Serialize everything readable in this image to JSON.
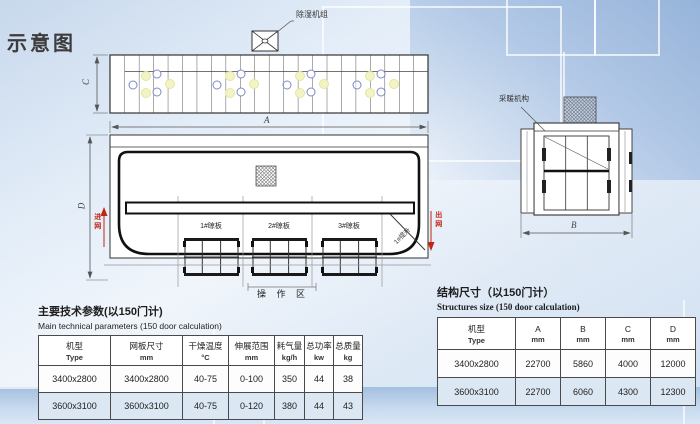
{
  "page": {
    "title": "示意图"
  },
  "colors": {
    "accent_red": "#c32413",
    "row_stripe": "#dbe7f3",
    "bg_top": "#c7d8ec",
    "bg_band": "#a3bfe0"
  },
  "diagram": {
    "top_view": {
      "dim_c": "C",
      "dehumidifier_label": "除湿机组"
    },
    "side_view": {
      "dim_a": "A",
      "dim_d": "D",
      "inlet_label": "进网",
      "outlet_label": "出网",
      "station1_label": "1#晾板",
      "station2_label": "2#晾板",
      "station3_label": "3#晾板",
      "lift_label": "1#提升",
      "operation_area_label": "操 作 区"
    },
    "end_view": {
      "dim_b": "B",
      "heater_label": "采暖机构"
    }
  },
  "tables": {
    "main": {
      "title": "主要技术参数(以150门计)",
      "subtitle": "Main technical parameters (150 door calculation)",
      "columns": [
        {
          "zh": "机型",
          "sub": "Type"
        },
        {
          "zh": "网板尺寸",
          "sub": "mm"
        },
        {
          "zh": "干燥温度",
          "sub": "°C"
        },
        {
          "zh": "伸展范围",
          "sub": "mm"
        },
        {
          "zh": "耗气量",
          "sub": "kg/h"
        },
        {
          "zh": "总功率",
          "sub": "kw"
        },
        {
          "zh": "总质量",
          "sub": "kg"
        }
      ],
      "rows": [
        [
          "3400x2800",
          "3400x2800",
          "40-75",
          "0-100",
          "350",
          "44",
          "38"
        ],
        [
          "3600x3100",
          "3600x3100",
          "40-75",
          "0-120",
          "380",
          "44",
          "43"
        ]
      ]
    },
    "structure": {
      "title": "结构尺寸（以150门计）",
      "subtitle": "Structures size (150 door calculation)",
      "columns": [
        {
          "zh": "机型",
          "sub": "Type"
        },
        {
          "zh": "A",
          "sub": "mm"
        },
        {
          "zh": "B",
          "sub": "mm"
        },
        {
          "zh": "C",
          "sub": "mm"
        },
        {
          "zh": "D",
          "sub": "mm"
        }
      ],
      "rows": [
        [
          "3400x2800",
          "22700",
          "5860",
          "4000",
          "12000"
        ],
        [
          "3600x3100",
          "22700",
          "6060",
          "4300",
          "12300"
        ]
      ]
    }
  }
}
